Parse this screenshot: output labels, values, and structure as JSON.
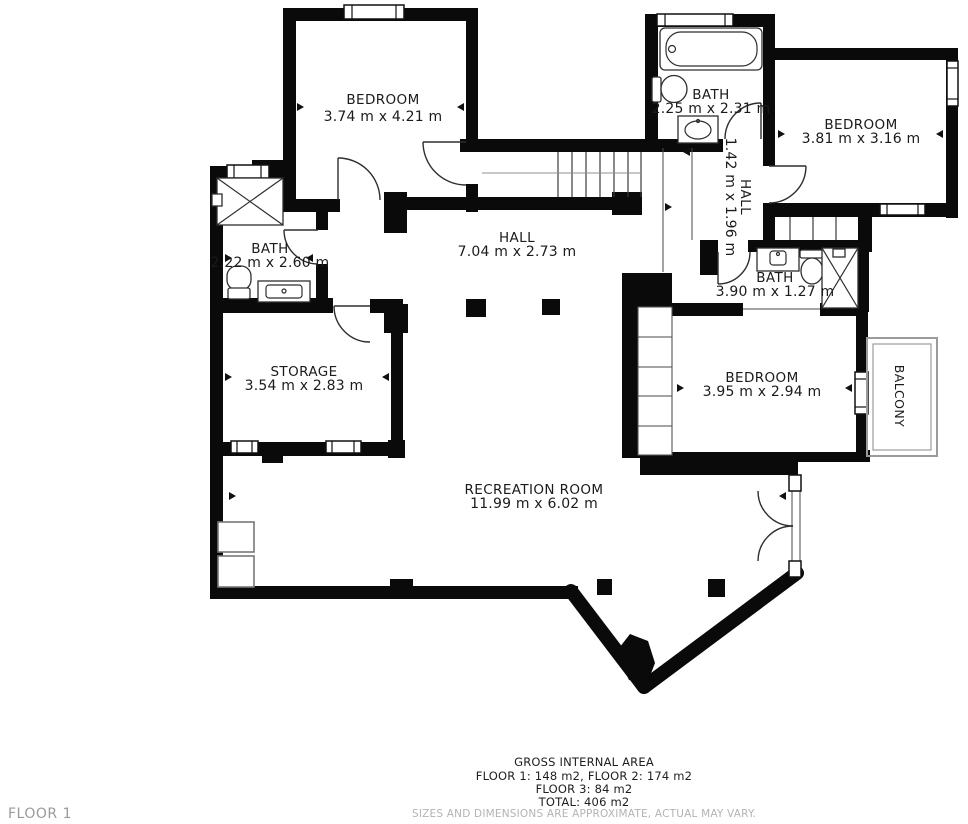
{
  "floor_label": "FLOOR 1",
  "rooms": {
    "bedroom_top_left": {
      "name": "BEDROOM",
      "dims": "3.74 m x 4.21 m"
    },
    "bath_top": {
      "name": "BATH",
      "dims": "2.25 m x 2.31 m"
    },
    "bedroom_top_right": {
      "name": "BEDROOM",
      "dims": "3.81 m x 3.16 m"
    },
    "hall_small": {
      "name": "HALL",
      "dims": "1.42 m x 1.96 m"
    },
    "bath_left": {
      "name": "BATH",
      "dims": "2.22 m x 2.60 m"
    },
    "hall_main": {
      "name": "HALL",
      "dims": "7.04 m x 2.73 m"
    },
    "bath_right": {
      "name": "BATH",
      "dims": "3.90 m x 1.27 m"
    },
    "storage": {
      "name": "STORAGE",
      "dims": "3.54 m x 2.83 m"
    },
    "bedroom_right": {
      "name": "BEDROOM",
      "dims": "3.95 m x 2.94 m"
    },
    "balcony": {
      "name": "BALCONY"
    },
    "recreation": {
      "name": "RECREATION ROOM",
      "dims": "11.99 m x 6.02 m"
    }
  },
  "footer": {
    "title": "GROSS INTERNAL AREA",
    "line2": "FLOOR 1: 148 m2, FLOOR 2: 174 m2",
    "line3": "FLOOR 3: 84 m2",
    "line4": "TOTAL: 406 m2",
    "disclaimer": "SIZES AND DIMENSIONS ARE APPROXIMATE, ACTUAL MAY VARY."
  },
  "colors": {
    "wall": "#0a0a0a",
    "label": "#1b1b1b",
    "muted_gray": "#9a9a9a",
    "disclaimer_gray": "#b3b3b3"
  }
}
